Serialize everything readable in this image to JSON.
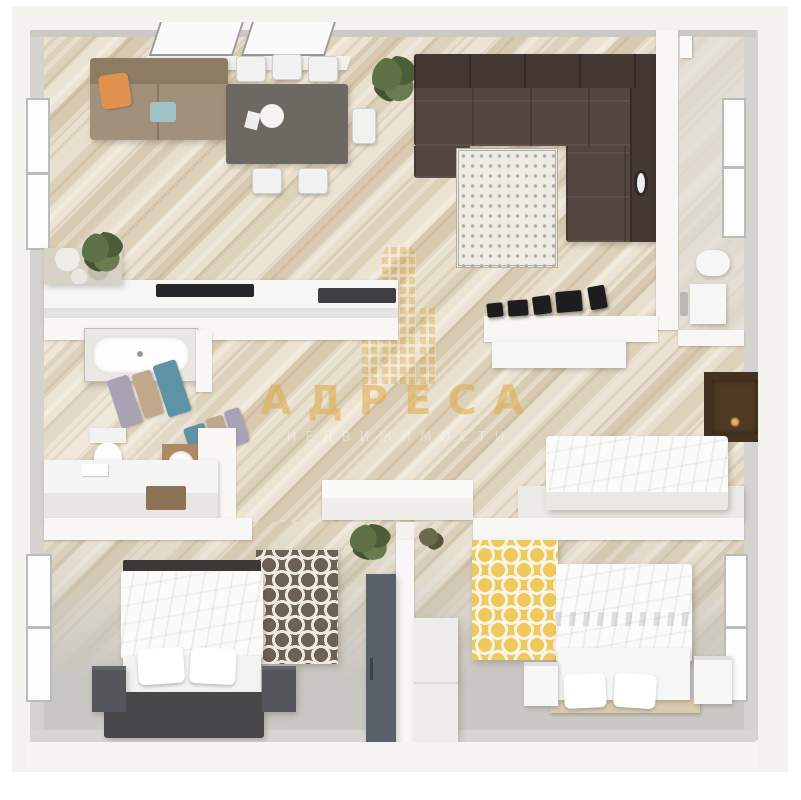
{
  "meta": {
    "title": "3D top-down apartment floor plan render",
    "style": "dollhouse perspective, light wood floors, white walls"
  },
  "watermark": {
    "brand_text": "АДРЕСА",
    "subtitle_text": "НЕДВИЖИМОСТИ",
    "logo_icon": "building-icon",
    "brand_color": "#deaa42"
  },
  "palette": {
    "floor_wood": "#e4d9c5",
    "floor_gray": "#c8c6c2",
    "wall_white": "#f8f7f5",
    "wall_face_gray": "#d5d3cf",
    "corner_sofa_brown": "#544540",
    "loveseat_tan": "#a2917a",
    "pillow_orange": "#e0914d",
    "dining_table_gray": "#6e6863",
    "rug_living": "#efece6",
    "rug_honeycomb_brown": "#6f6055",
    "rug_honeycomb_yellow": "#f0c95e",
    "towel_blue": "#5e93a6",
    "towel_tan": "#bfa88c",
    "towel_lavender": "#a8a2b4",
    "tv_panel_brown": "#43321f",
    "wardrobe_slate": "#59606a",
    "nightstand_dark": "#54565b",
    "bed_bench_dark": "#48484b",
    "vanity_wood": "#ad8a60",
    "plant_green": "#56683f"
  },
  "rooms": [
    {
      "id": "living-dining-kitchen",
      "furniture": [
        "skylight-windows",
        "left-window",
        "tan-loveseat",
        "orange-pillow",
        "dining-table",
        "six-chairs",
        "plate",
        "plant",
        "brown-corner-sofa",
        "patterned-rug",
        "wall-clock",
        "kitchen-counter",
        "marble-cabinet",
        "cooktop",
        "counter-plant",
        "speaker-row"
      ]
    },
    {
      "id": "wc-top-right",
      "furniture": [
        "right-window",
        "boiler",
        "toilet",
        "vanity-cabinet",
        "faucet"
      ]
    },
    {
      "id": "bathroom",
      "furniture": [
        "bathtub",
        "towel-rail-a",
        "towel-rail-b",
        "toilet",
        "wood-vanity-sink",
        "counter",
        "brown-mat"
      ]
    },
    {
      "id": "hallway",
      "furniture": [
        "sideboard-cabinet",
        "closet-unit",
        "watermark-logo"
      ]
    },
    {
      "id": "study-room",
      "furniture": [
        "wall-tv-panel",
        "white-daybed",
        "platform"
      ]
    },
    {
      "id": "bedroom-left",
      "furniture": [
        "left-window",
        "double-bed",
        "two-pillows",
        "dark-nightstands",
        "dark-bench",
        "brown-honeycomb-rug",
        "slate-wardrobe"
      ]
    },
    {
      "id": "bedroom-right",
      "furniture": [
        "right-window",
        "double-bed",
        "two-pillows",
        "white-nightstands",
        "yellow-honeycomb-rug",
        "white-wardrobe",
        "tan-platform",
        "plants"
      ]
    }
  ]
}
